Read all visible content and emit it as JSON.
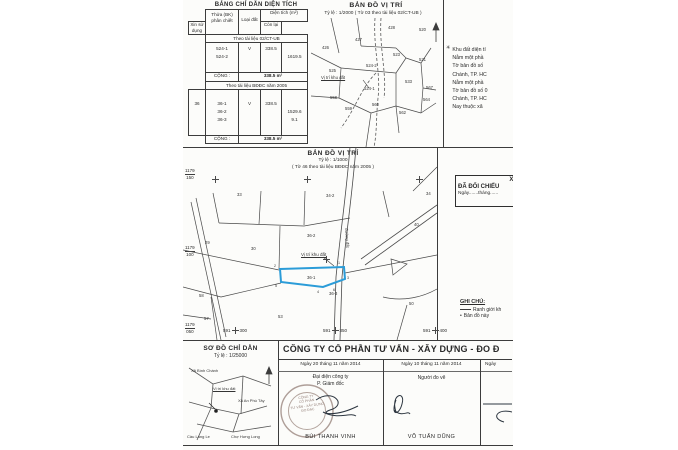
{
  "colors": {
    "ink": "#2a2a2a",
    "line": "#4a4a4a",
    "parcel_blue": "#2b9cd8",
    "stamp": "#a08d86",
    "paper": "#fcfcfa"
  },
  "area_table": {
    "title": "BẢNG CHỈ DẪN DIỆN TÍCH",
    "headers": {
      "plot_l1": "Thửa (BK)",
      "plot_l2": "phân chiết",
      "land_type": "Loại đất",
      "area": "Diện tích (m²)",
      "requested": "Xin sử dụng",
      "remaining": "Còn lại"
    },
    "section1": {
      "band": "Theo tài liệu 02/CT-UB",
      "row1": {
        "id": "524-1",
        "land_type": "V",
        "requested": "338.5"
      },
      "row2": {
        "id": "524-2",
        "remaining": "1619.5"
      },
      "total_label": "CỘNG :",
      "total_value": "338.5 m²"
    },
    "section2": {
      "band": "Theo tài liệu BĐĐC năm 2005",
      "sheet": "36",
      "id1": "36-1",
      "id2": "36-2",
      "id3": "36-3",
      "land_type": "V",
      "requested": "338.5",
      "remaining1": "1529.6",
      "remaining2": "9.1",
      "total_label": "CỘNG :",
      "total_value": "338.5 m²"
    }
  },
  "map2000": {
    "title": "BẢN ĐỒ VỊ TRÍ",
    "subtitle": "Tỷ lệ : 1/2000 ( Tờ 03 theo tài liệu 02/CT-UB )",
    "location_label": "Vị trí khu đất",
    "parcels": [
      "426",
      "427",
      "428",
      "520",
      "523",
      "521",
      "524-2",
      "525",
      "524-1",
      "558",
      "559",
      "560",
      "562",
      "533",
      "567",
      "564"
    ]
  },
  "side_note": {
    "marker": "✳",
    "lines": [
      "Khu đất diện tí",
      "Nằm một phầ",
      "Tờ bản đồ số",
      "Chánh, TP. HC",
      "Nằm một phầ",
      "Tờ bản đồ số 0",
      "Chánh, TP. HC",
      "Nay thuộc xã"
    ]
  },
  "cert_box": {
    "line1": "XÁC N",
    "line2": "ĐÃ ĐỐI CHIẾU",
    "line3": "Ngày.......tháng......"
  },
  "map1000": {
    "title": "BẢN ĐỒ VỊ TRÍ",
    "scale": "Tỷ lệ : 1/1000",
    "subtitle": "( Tờ 46 theo tài liệu BĐĐC năm 2005 )",
    "location_label": "Vị trí khu đất",
    "road_label": "đường đất",
    "grid_left": [
      {
        "top": "1179",
        "bottom": "150"
      },
      {
        "top": "1179",
        "bottom": "100"
      },
      {
        "top": "1179",
        "bottom": "050"
      }
    ],
    "grid_bottom": [
      {
        "left": "591",
        "right": "300"
      },
      {
        "left": "591",
        "right": "350"
      },
      {
        "left": "591",
        "right": "400"
      }
    ],
    "parcels": [
      "33",
      "34-2",
      "34",
      "29",
      "30",
      "36-2",
      "40",
      "36-1",
      "36-3",
      "58",
      "53",
      "50",
      "57"
    ],
    "vertices": [
      "2",
      "1",
      "3",
      "6",
      "4",
      "5"
    ]
  },
  "legend": {
    "title": "GHI CHÚ:",
    "item1": "Ranh giới kh",
    "item2": "Bản đồ này"
  },
  "sketch": {
    "title": "SƠ ĐỒ CHỈ DẪN",
    "scale": "Tỷ lệ : 1/25000",
    "labels": [
      "Xã Bình Chánh",
      "Vị trí khu đất",
      "Xã An Phú Tây",
      "Cầu Láng Le",
      "Chợ Hưng Long"
    ]
  },
  "company": {
    "title": "CÔNG TY CỔ PHẦN TƯ VẤN - XÂY DỰNG - ĐO Đ",
    "col1": {
      "date": "Ngày 20 tháng 11 năm 2014",
      "role_l1": "Đại diện công ty",
      "role_l2": "P. Giám đốc",
      "name": "BÙI THANH VINH"
    },
    "col2": {
      "date": "Ngày 10 tháng 11 năm 2014",
      "role": "Người đo vẽ",
      "name": "VÕ TUẤN DŨNG"
    },
    "col3": {
      "date": "Ngày"
    },
    "stamp": {
      "l1": "CÔNG TY",
      "l2": "CỔ PHẦN",
      "l3": "TƯ VẤN - XÂY DỰNG",
      "l4": "ĐO ĐẠC"
    }
  }
}
